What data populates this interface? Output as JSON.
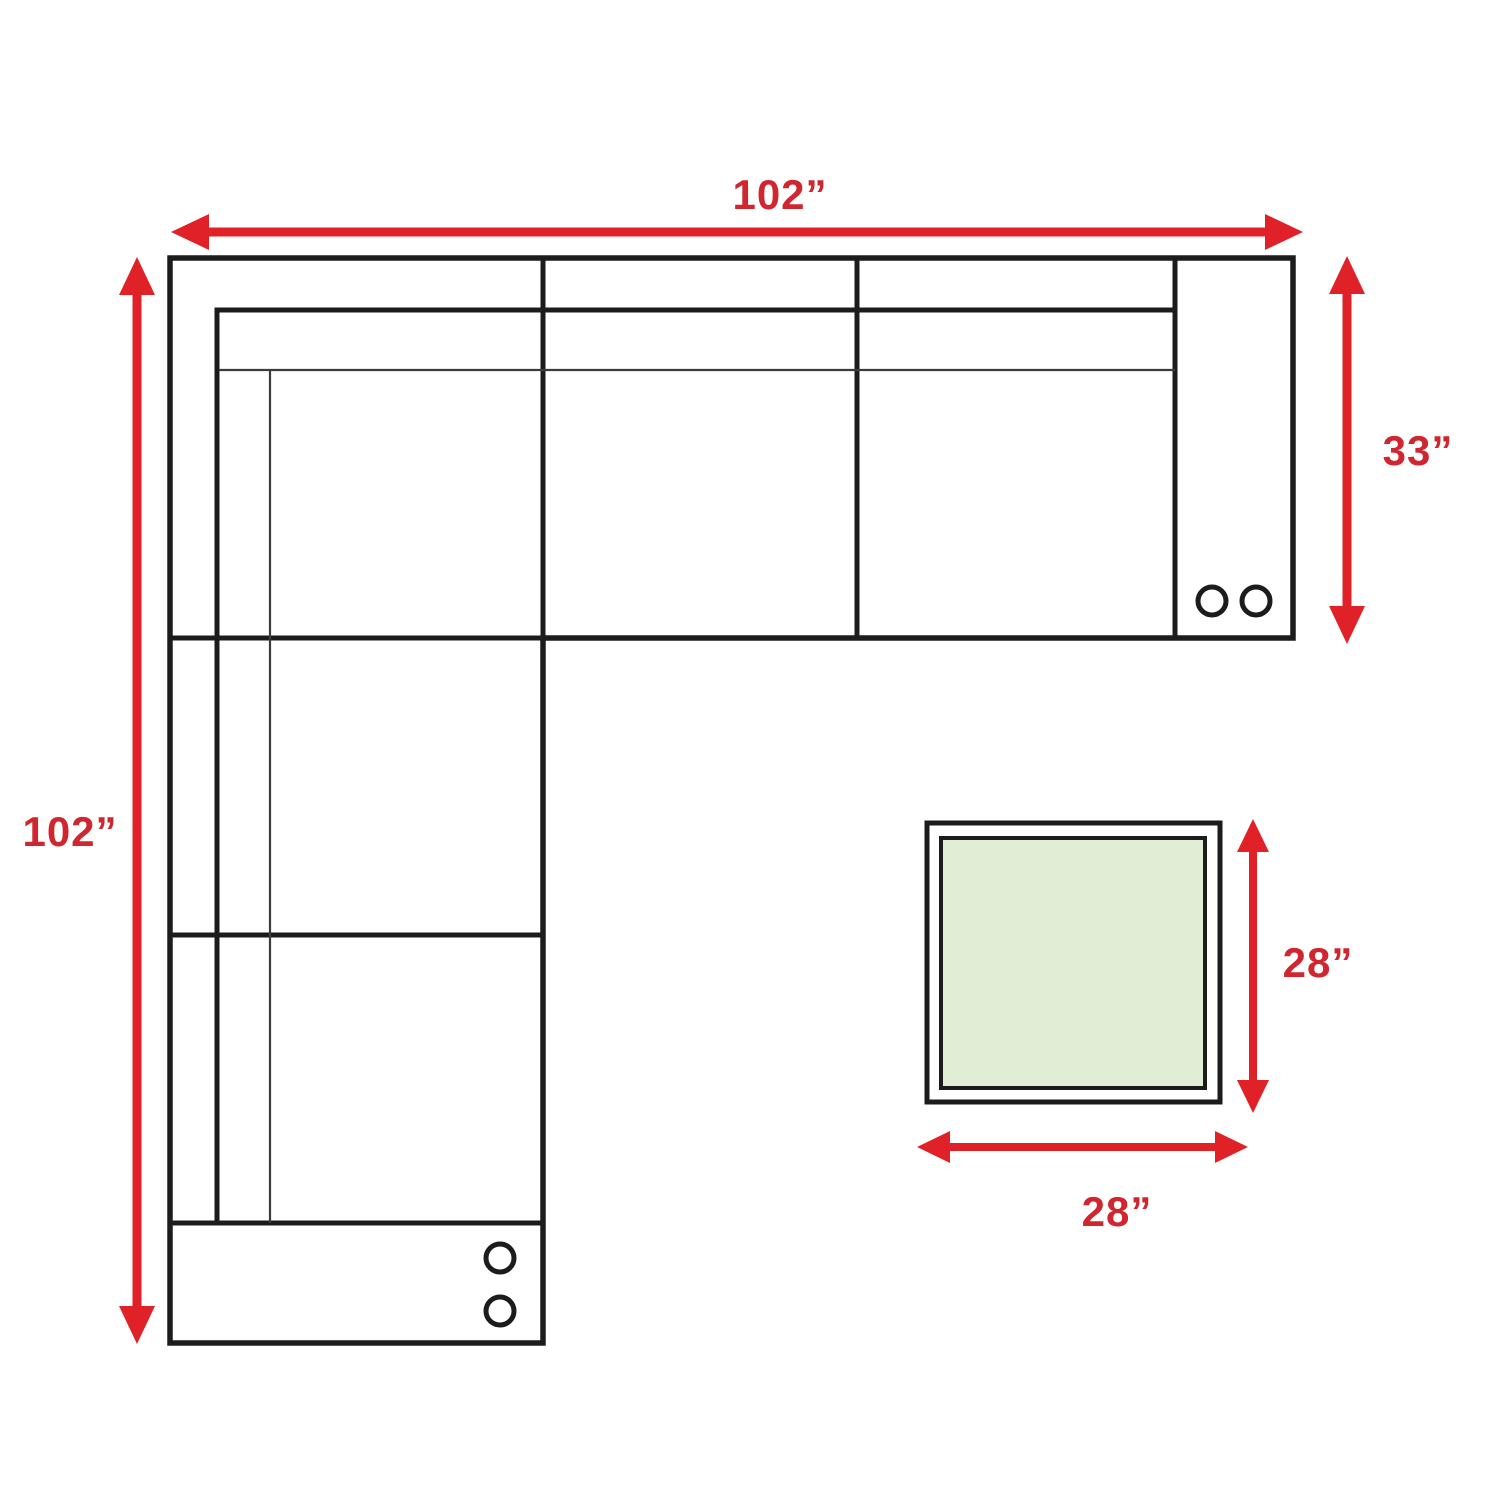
{
  "diagram": {
    "title": "sectional-sofa-and-table-dimension-diagram",
    "labels": {
      "top_width": "102”",
      "left_depth": "102”",
      "right_section_depth": "33”",
      "table_depth": "28”",
      "table_width": "28”"
    },
    "colors": {
      "arrow": "#e02128",
      "label": "#d02630",
      "outline": "#1c1c1c",
      "thin_line": "#3c3c3c",
      "table_fill": "#e2edd5",
      "background": "#ffffff"
    }
  }
}
